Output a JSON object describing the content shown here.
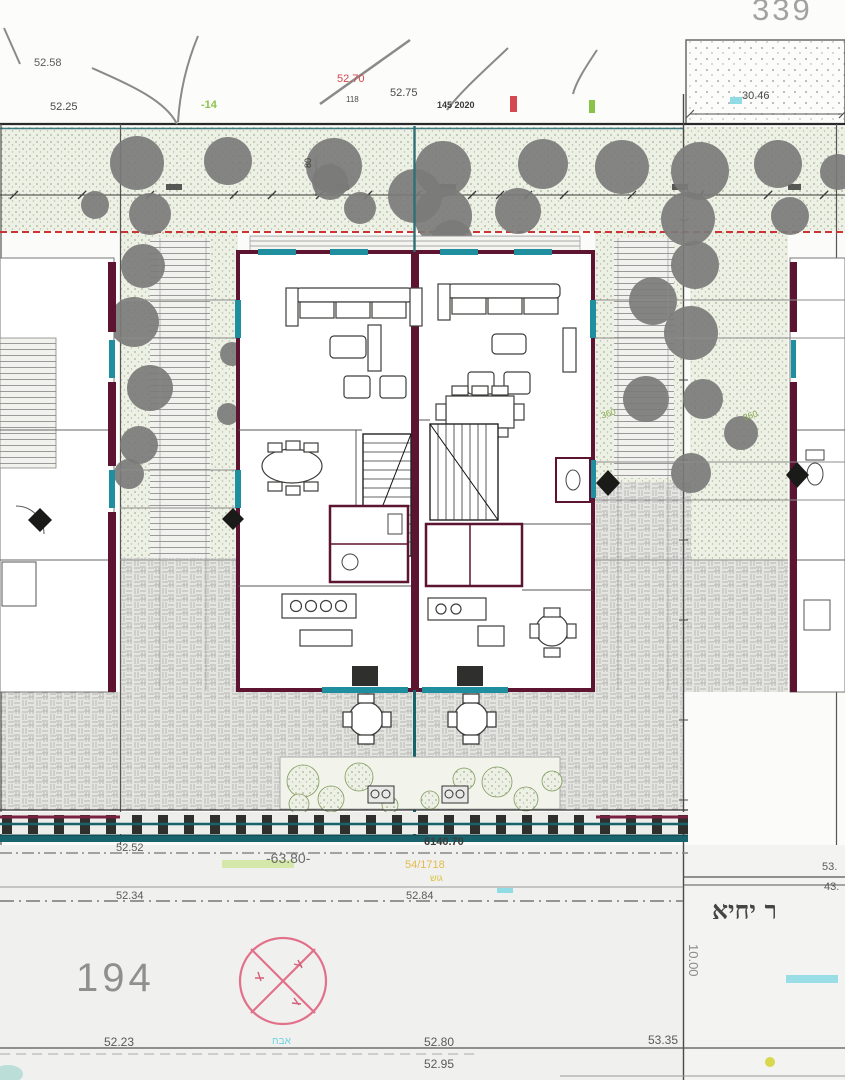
{
  "colors": {
    "wall_maroon": "#5c1430",
    "glazing_teal": "#1f8fa0",
    "fence_teal": "#17626b",
    "setback_red": "#cc3333",
    "tree_gray": "#7b7b79",
    "compass_pink": "#e2708a",
    "garden_stipple": "#edf0e4",
    "orange_note": "#e2bb4e"
  },
  "plan": {
    "parcel_north": "339",
    "parcel_south": "194",
    "street_name": "ר יחיא",
    "labels": [
      {
        "id": "parcel-north-number",
        "text": "339",
        "x": 752,
        "y": -6,
        "s": 31,
        "c": "#a2a2a0",
        "ls": 3
      },
      {
        "id": "spot-level-52-58",
        "text": "52.58",
        "x": 34,
        "y": 58,
        "s": 11,
        "c": "#5a5a58"
      },
      {
        "id": "spot-level-52-25",
        "text": "52.25",
        "x": 50,
        "y": 102,
        "s": 11,
        "c": "#4a4a48"
      },
      {
        "id": "spot-level-52-70-red",
        "text": "52.70",
        "x": 337,
        "y": 74,
        "s": 11,
        "c": "#d4494f"
      },
      {
        "id": "spot-level-118",
        "text": "118",
        "x": 346,
        "y": 96,
        "s": 8,
        "c": "#4a4a48"
      },
      {
        "id": "spot-level-52-75",
        "text": "52.75",
        "x": 390,
        "y": 88,
        "s": 11,
        "c": "#4a4a48"
      },
      {
        "id": "boundary-note-145-2020",
        "text": "145 2020",
        "x": 437,
        "y": 101,
        "s": 9,
        "c": "#3a3a38",
        "bold": true
      },
      {
        "id": "green-mark-minus-14",
        "text": "-14",
        "x": 201,
        "y": 100,
        "s": 11,
        "c": "#8bc34a",
        "bold": true
      },
      {
        "id": "dim-30-46",
        "text": "30.46",
        "x": 742,
        "y": 91,
        "s": 11,
        "c": "#4a4a48"
      },
      {
        "id": "dim-80-rotated",
        "text": "80",
        "x": 304,
        "y": 168,
        "s": 9,
        "c": "#3a3a38",
        "rot": -90
      },
      {
        "id": "note-360-a",
        "text": "360",
        "x": 600,
        "y": 412,
        "s": 9,
        "c": "#86a84e",
        "rot": -18
      },
      {
        "id": "note-360-b",
        "text": "360",
        "x": 742,
        "y": 414,
        "s": 9,
        "c": "#86a84e",
        "rot": -18
      },
      {
        "id": "spot-level-52-52",
        "text": "52.52",
        "x": 116,
        "y": 843,
        "s": 11,
        "c": "#5a5a58"
      },
      {
        "id": "road-level-63-80",
        "text": "-63.80-",
        "x": 266,
        "y": 851,
        "s": 14,
        "c": "#6a6a68"
      },
      {
        "id": "spot-level-6140-70",
        "text": "6140.70",
        "x": 424,
        "y": 837,
        "s": 11,
        "c": "#3a3a38",
        "bold": true
      },
      {
        "id": "orange-note-54-1718",
        "text": "54/1718",
        "x": 405,
        "y": 860,
        "s": 11,
        "c": "#e2bb4e"
      },
      {
        "id": "orange-note-gush",
        "text": "גוש",
        "x": 430,
        "y": 874,
        "s": 9,
        "c": "#d9c33e"
      },
      {
        "id": "spot-level-52-34",
        "text": "52.34",
        "x": 116,
        "y": 891,
        "s": 11,
        "c": "#5a5a58"
      },
      {
        "id": "spot-level-52-84",
        "text": "52.84",
        "x": 406,
        "y": 891,
        "s": 11,
        "c": "#5a5a58"
      },
      {
        "id": "parcel-south-number",
        "text": "194",
        "x": 76,
        "y": 958,
        "s": 40,
        "c": "#8f8f8d",
        "ls": 4
      },
      {
        "id": "spot-level-52-23",
        "text": "52.23",
        "x": 104,
        "y": 1036,
        "s": 12,
        "c": "#5a5a58"
      },
      {
        "id": "cyan-note",
        "text": "אבח",
        "x": 272,
        "y": 1037,
        "s": 10,
        "c": "#6fd4de"
      },
      {
        "id": "spot-level-52-80",
        "text": "52.80",
        "x": 424,
        "y": 1036,
        "s": 12,
        "c": "#5a5a58"
      },
      {
        "id": "spot-level-52-95",
        "text": "52.95",
        "x": 424,
        "y": 1058,
        "s": 12,
        "c": "#5a5a58"
      },
      {
        "id": "spot-level-53-35",
        "text": "53.35",
        "x": 648,
        "y": 1034,
        "s": 12,
        "c": "#5a5a58"
      },
      {
        "id": "dim-10-00-rotated",
        "text": "10.00",
        "x": 700,
        "y": 944,
        "s": 13,
        "c": "#8a8a88",
        "rot": 90
      },
      {
        "id": "street-name",
        "text": "ר יחיא",
        "x": 712,
        "y": 898,
        "s": 25,
        "c": "#454543",
        "bold": true,
        "serif": true
      },
      {
        "id": "spot-level-53-right-clipped",
        "text": "53.",
        "x": 822,
        "y": 862,
        "s": 11,
        "c": "#5a5a58"
      },
      {
        "id": "spot-level-43-right-clipped",
        "text": "43.",
        "x": 824,
        "y": 882,
        "s": 11,
        "c": "#5a5a58"
      }
    ]
  }
}
